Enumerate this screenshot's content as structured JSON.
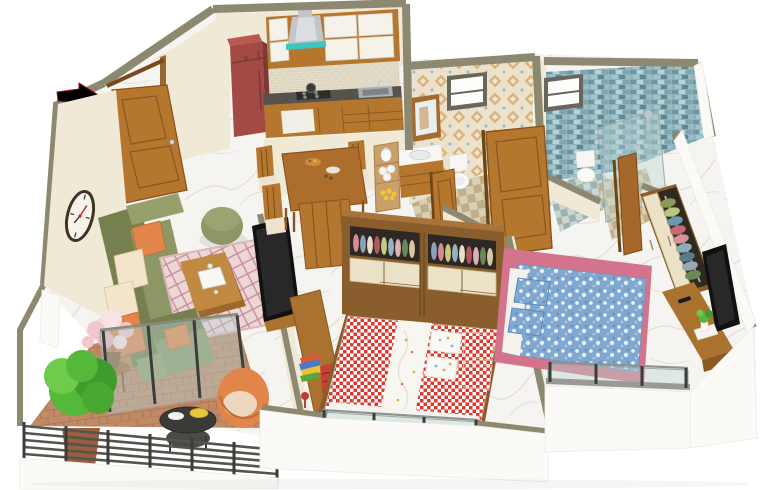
{
  "scene": {
    "kind": "3d-isometric-floor-plan-render",
    "background": "#ffffff",
    "width": 780,
    "height": 490
  },
  "indicators": {
    "entrance_arrow": {
      "name": "entrance-arrow",
      "shape": "right-arrow",
      "color": "#e8120f"
    }
  },
  "palette": {
    "background": "#ffffff",
    "wall_cap": "#8d8970",
    "wall_cream": "#efe9d6",
    "wall_white": "#fbfaf7",
    "floor_marble": "#f6f4f0",
    "floor_terracotta": "#c18a66",
    "wood": "#b5772e",
    "wood_dark": "#8a5e2c",
    "wood_frame": "#6a4515",
    "fridge_maroon": "#a34a44",
    "cabinet_white": "#f5f2ea",
    "counter_dark": "#55534c",
    "chimney_steel": "#c2c6ca",
    "chimney_teal": "#3cc6c2",
    "sofa_olive": "#8d9765",
    "sofa_olive_dark": "#76804f",
    "pillow_orange": "#e2854a",
    "pillow_cream": "#f3e4cb",
    "rug_pink": "#ecd7d5",
    "rug_pattern": "#c9879a",
    "bed_red_checker": "#d93b2f",
    "bed_blue_floral": "#7fa8d0",
    "bed_pink_frame": "#d4748c",
    "tile_diamond_beige": "#d9a96b",
    "tile_mosaic_blue": "#8fb3bc",
    "floor_checker_beige": "#bfae87",
    "floor_checker_blue": "#9ab3b5",
    "railing_metal": "#55544e",
    "tv_black": "#111111",
    "plant_green": "#55b83a",
    "blossom_pink": "#f2c6cc",
    "clock_dark": "#3f3326",
    "chair_red": "#c03a34",
    "clothes_rolls": [
      "#d88a96",
      "#8aa0b8",
      "#e8e0c6",
      "#b05a60",
      "#cac87c",
      "#98b0c6",
      "#e0b0b8",
      "#6a8a5a",
      "#d8c8a0"
    ]
  },
  "rooms": {
    "entrance": {
      "items": [
        "entrance-door",
        "door-frame",
        "entrance-arrow"
      ]
    },
    "living_room": {
      "items": [
        "wall-clock",
        "sofa",
        "orange-pillows",
        "cream-pillows",
        "pouf",
        "area-rug",
        "coffee-table",
        "armchair",
        "side-table",
        "blossom-vase",
        "tv-partition",
        "television"
      ]
    },
    "living_balcony": {
      "items": [
        "glass-partition",
        "potted-plant",
        "round-table",
        "snack-plates",
        "tub-chair",
        "metal-railing"
      ]
    },
    "kitchen": {
      "items": [
        "refrigerator",
        "upper-cabinets",
        "chimney-hood",
        "tile-backsplash",
        "countertop",
        "gas-hob",
        "sink",
        "lower-cabinets",
        "peninsula-half-wall"
      ]
    },
    "dining": {
      "items": [
        "dining-table",
        "dining-chairs",
        "fruit-bowls",
        "niche-shelf",
        "jar",
        "towel-rolls",
        "marigold-flowers"
      ]
    },
    "bathroom_common": {
      "items": [
        "diamond-tile-wall",
        "window",
        "mirror",
        "vanity-basin",
        "toilet",
        "wooden-door",
        "checker-floor"
      ]
    },
    "bathroom_master": {
      "items": [
        "blue-mosaic-wall",
        "window",
        "shower-enclosure",
        "shower-head",
        "toilet",
        "wooden-door",
        "checker-floor"
      ]
    },
    "master_bedroom": {
      "items": [
        "wardrobe",
        "clothes-rolls",
        "double-bed-red-checker",
        "floral-pillows",
        "study-desk",
        "books",
        "table-lamp",
        "red-chair",
        "window-railing",
        "parapet"
      ]
    },
    "bedroom_two": {
      "items": [
        "wooden-door",
        "double-bed-blue-floral",
        "pink-bed-frame",
        "blue-pillows",
        "wardrobe",
        "clothes-rolls",
        "tv-unit",
        "television",
        "remote-control",
        "potted-plant",
        "balcony-railing",
        "parapet"
      ]
    }
  }
}
